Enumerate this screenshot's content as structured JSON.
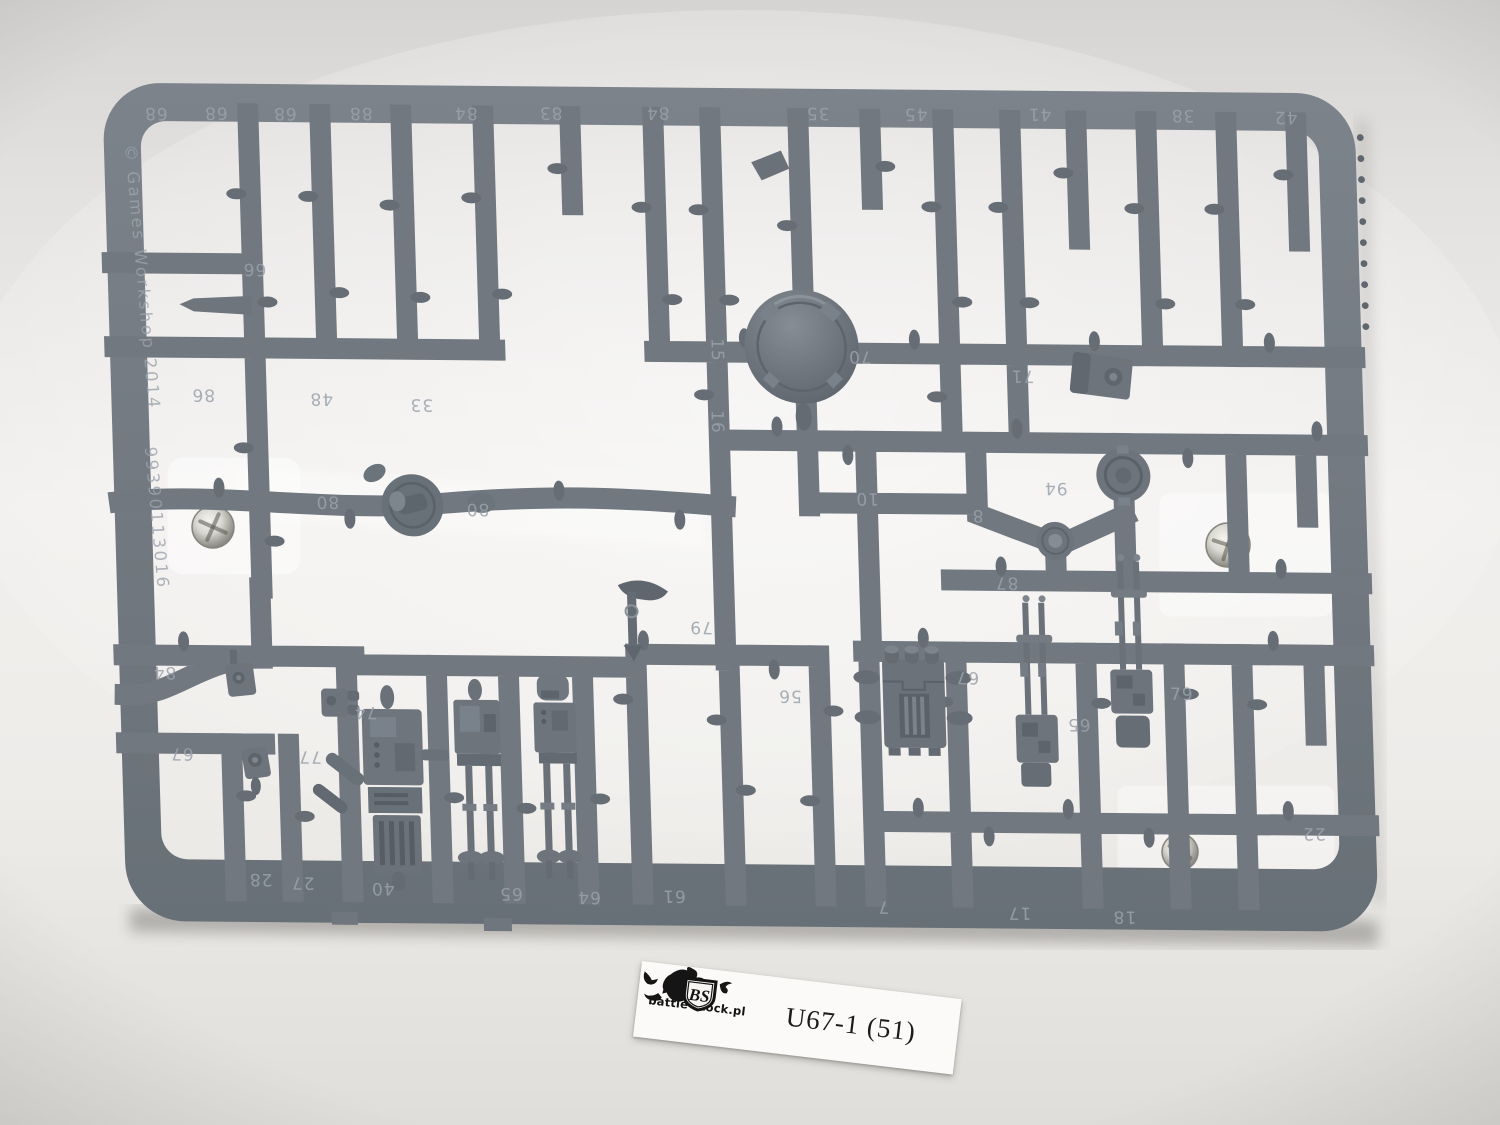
{
  "photo": {
    "background_color": "#EFEDEB",
    "plastic_color": "#71787F",
    "label_color": "#FBFAF8"
  },
  "sprue": {
    "copyright": "© Games Workshop 2014",
    "product_code": "99390113016",
    "stamped_numbers": [
      {
        "n": "68",
        "x": 148,
        "y": 113,
        "rot": 180
      },
      {
        "n": "68",
        "x": 208,
        "y": 112,
        "rot": 180
      },
      {
        "n": "68",
        "x": 277,
        "y": 112,
        "rot": 180
      },
      {
        "n": "88",
        "x": 353,
        "y": 111,
        "rot": 180
      },
      {
        "n": "84",
        "x": 458,
        "y": 110,
        "rot": 180
      },
      {
        "n": "83",
        "x": 543,
        "y": 109,
        "rot": 180
      },
      {
        "n": "84",
        "x": 650,
        "y": 108,
        "rot": 180
      },
      {
        "n": "35",
        "x": 810,
        "y": 107,
        "rot": 180
      },
      {
        "n": "45",
        "x": 908,
        "y": 107,
        "rot": 180
      },
      {
        "n": "41",
        "x": 1032,
        "y": 106,
        "rot": 180
      },
      {
        "n": "38",
        "x": 1175,
        "y": 106,
        "rot": 180
      },
      {
        "n": "42",
        "x": 1278,
        "y": 107,
        "rot": 180
      },
      {
        "n": "66",
        "x": 242,
        "y": 268,
        "rot": 180
      },
      {
        "n": "86",
        "x": 187,
        "y": 394,
        "rot": 180
      },
      {
        "n": "48",
        "x": 305,
        "y": 397,
        "rot": 180
      },
      {
        "n": "33",
        "x": 405,
        "y": 402,
        "rot": 180
      },
      {
        "n": "15",
        "x": 697,
        "y": 350,
        "rot": 90
      },
      {
        "n": "70",
        "x": 845,
        "y": 350,
        "rot": 180
      },
      {
        "n": "16",
        "x": 695,
        "y": 422,
        "rot": 90
      },
      {
        "n": "10",
        "x": 848,
        "y": 492,
        "rot": 180
      },
      {
        "n": "8",
        "x": 958,
        "y": 508,
        "rot": 180
      },
      {
        "n": "80",
        "x": 308,
        "y": 500,
        "rot": 180
      },
      {
        "n": "80",
        "x": 458,
        "y": 506,
        "rot": 180
      },
      {
        "n": "71",
        "x": 1007,
        "y": 368,
        "rot": 180
      },
      {
        "n": "94",
        "x": 1037,
        "y": 480,
        "rot": 180
      },
      {
        "n": "87",
        "x": 985,
        "y": 575,
        "rot": 180
      },
      {
        "n": "79",
        "x": 678,
        "y": 622,
        "rot": 180
      },
      {
        "n": "79",
        "x": 1157,
        "y": 696,
        "rot": 0
      },
      {
        "n": "65",
        "x": 1053,
        "y": 716,
        "rot": 180
      },
      {
        "n": "56",
        "x": 765,
        "y": 690,
        "rot": 180
      },
      {
        "n": "67",
        "x": 943,
        "y": 670,
        "rot": 180
      },
      {
        "n": "84",
        "x": 140,
        "y": 672,
        "rot": 180
      },
      {
        "n": "67",
        "x": 155,
        "y": 753,
        "rot": 180
      },
      {
        "n": "74",
        "x": 340,
        "y": 710,
        "rot": 180
      },
      {
        "n": "77",
        "x": 283,
        "y": 755,
        "rot": 180
      },
      {
        "n": "22",
        "x": 1285,
        "y": 823,
        "rot": 180
      },
      {
        "n": "28",
        "x": 230,
        "y": 878,
        "rot": 180
      },
      {
        "n": "27",
        "x": 272,
        "y": 881,
        "rot": 180
      },
      {
        "n": "40",
        "x": 352,
        "y": 886,
        "rot": 180
      },
      {
        "n": "65",
        "x": 480,
        "y": 890,
        "rot": 180
      },
      {
        "n": "64",
        "x": 558,
        "y": 893,
        "rot": 180
      },
      {
        "n": "61",
        "x": 643,
        "y": 891,
        "rot": 180
      },
      {
        "n": "7",
        "x": 852,
        "y": 900,
        "rot": 180
      },
      {
        "n": "17",
        "x": 988,
        "y": 905,
        "rot": 180
      },
      {
        "n": "18",
        "x": 1093,
        "y": 908,
        "rot": 180
      }
    ]
  },
  "label": {
    "site": "battle-stock.pl",
    "code": "U67-1 (51)",
    "logo_initials": "BS"
  }
}
